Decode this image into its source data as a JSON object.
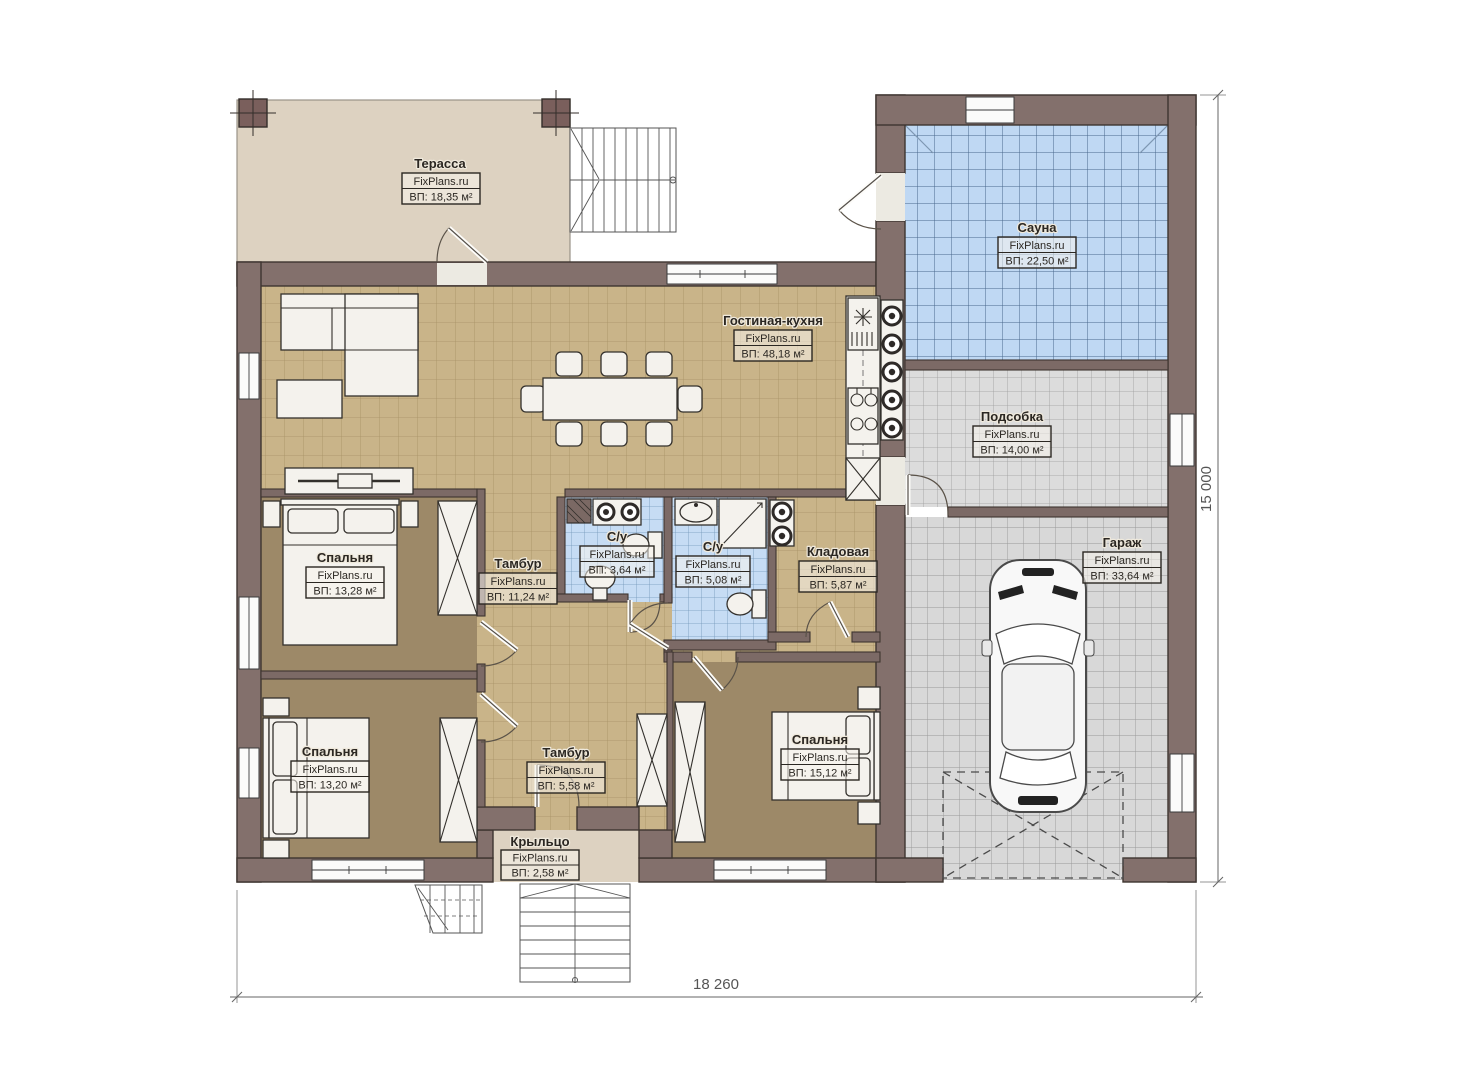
{
  "watermark": "FixPlans.ru",
  "dimensions": {
    "width": "18 260",
    "height": "15 000"
  },
  "rooms": [
    {
      "id": "terrace",
      "name": "Терасса",
      "area": "ВП: 18,35 м²"
    },
    {
      "id": "sauna",
      "name": "Сауна",
      "area": "ВП: 22,50 м²"
    },
    {
      "id": "living-kitchen",
      "name": "Гостиная-кухня",
      "area": "ВП: 48,18 м²"
    },
    {
      "id": "utility",
      "name": "Подсобка",
      "area": "ВП: 14,00 м²"
    },
    {
      "id": "bedroom-1",
      "name": "Спальня",
      "area": "ВП: 13,28 м²"
    },
    {
      "id": "vestibule-1",
      "name": "Тамбур",
      "area": "ВП: 11,24 м²"
    },
    {
      "id": "bath-1",
      "name": "С/у",
      "area": "ВП: 3,64 м²"
    },
    {
      "id": "bath-2",
      "name": "С/у",
      "area": "ВП: 5,08 м²"
    },
    {
      "id": "storage",
      "name": "Кладовая",
      "area": "ВП: 5,87 м²"
    },
    {
      "id": "garage",
      "name": "Гараж",
      "area": "ВП: 33,64 м²"
    },
    {
      "id": "bedroom-2",
      "name": "Спальня",
      "area": "ВП: 13,20 м²"
    },
    {
      "id": "vestibule-2",
      "name": "Тамбур",
      "area": "ВП: 5,58 м²"
    },
    {
      "id": "bedroom-3",
      "name": "Спальня",
      "area": "ВП: 15,12 м²"
    },
    {
      "id": "porch",
      "name": "Крыльцо",
      "area": "ВП: 2,58 м²"
    }
  ],
  "colors": {
    "wall": "#83706c",
    "floor_wood": "#c9b489",
    "floor_bedroom": "#9d8968",
    "tile_blue": "#c3d9f1",
    "tile_gray": "#dbdbdb",
    "terrace": "#ddd2c1"
  }
}
